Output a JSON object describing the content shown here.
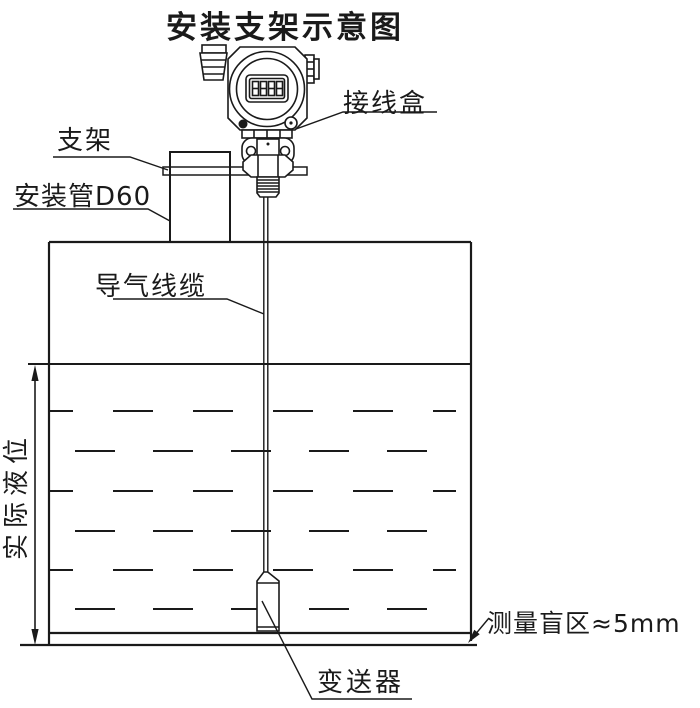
{
  "diagram": {
    "title": "安装支架示意图",
    "labels": {
      "junction_box": "接线盒",
      "bracket": "支架",
      "mounting_pipe": "安装管D60",
      "air_cable": "导气线缆",
      "actual_level": "实际液位",
      "blind_zone": "测量盲区≈5mm",
      "transmitter": "变送器"
    },
    "display_digits": "8888",
    "colors": {
      "line": "#1a1a1a",
      "background": "#ffffff"
    }
  }
}
